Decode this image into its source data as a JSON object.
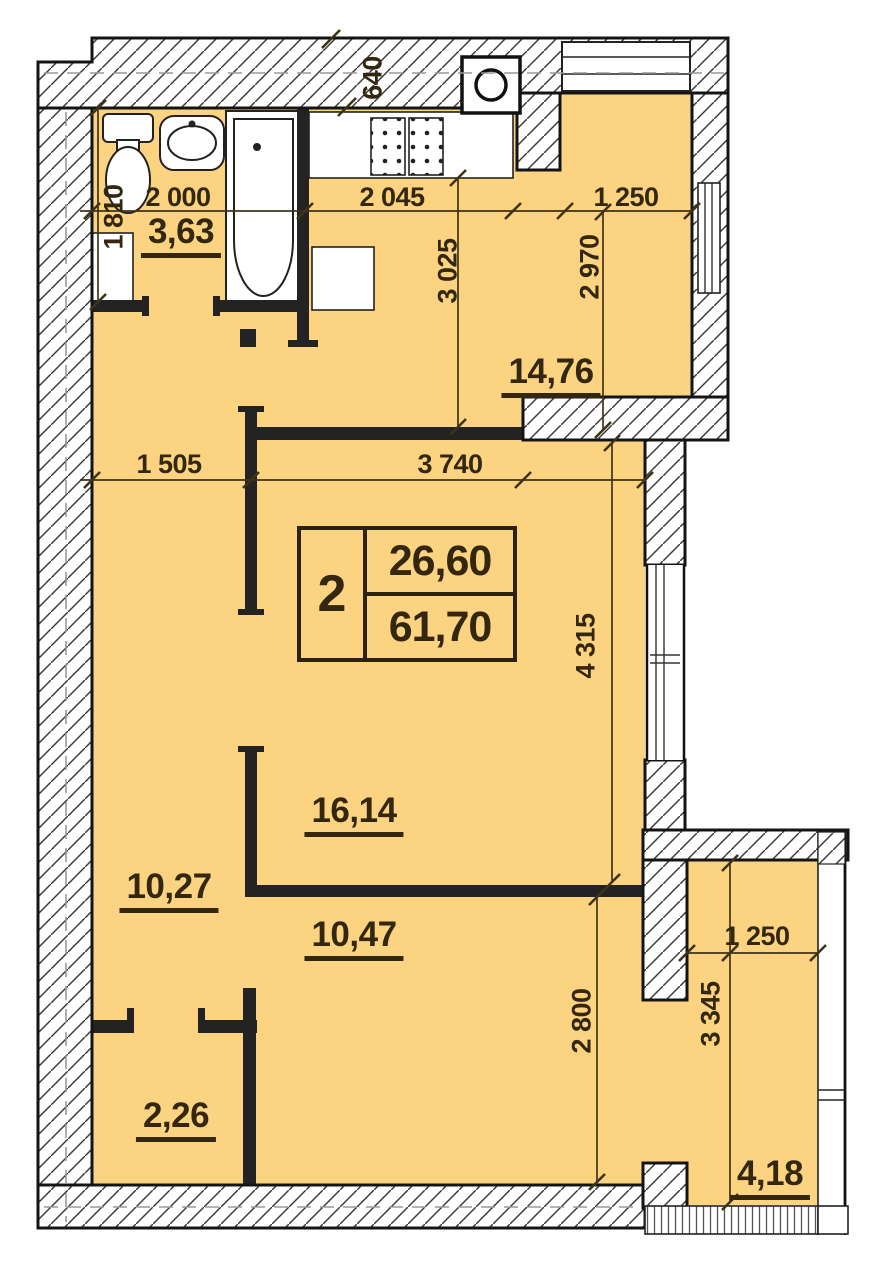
{
  "plan": {
    "unit_number": "2",
    "living_area": "26,60",
    "total_area": "61,70"
  },
  "room_areas": {
    "bathroom": "3,63",
    "kitchen_living": "14,76",
    "living_room": "16,14",
    "hallway": "10,27",
    "bedroom": "10,47",
    "storage": "2,26",
    "balcony": "4,18"
  },
  "dimensions": {
    "d640": "640",
    "d1810": "1 810",
    "d2000": "2 000",
    "d2045": "2 045",
    "d1250_top": "1 250",
    "d3025": "3 025",
    "d2970": "2 970",
    "d1505": "1 505",
    "d3740": "3 740",
    "d4315": "4 315",
    "d2800": "2 800",
    "d1250_balcony": "1 250",
    "d3345": "3 345"
  },
  "colors": {
    "floor_fill": "#FCD381",
    "wall_line": "#1A1A1A",
    "text": "#33270F"
  }
}
